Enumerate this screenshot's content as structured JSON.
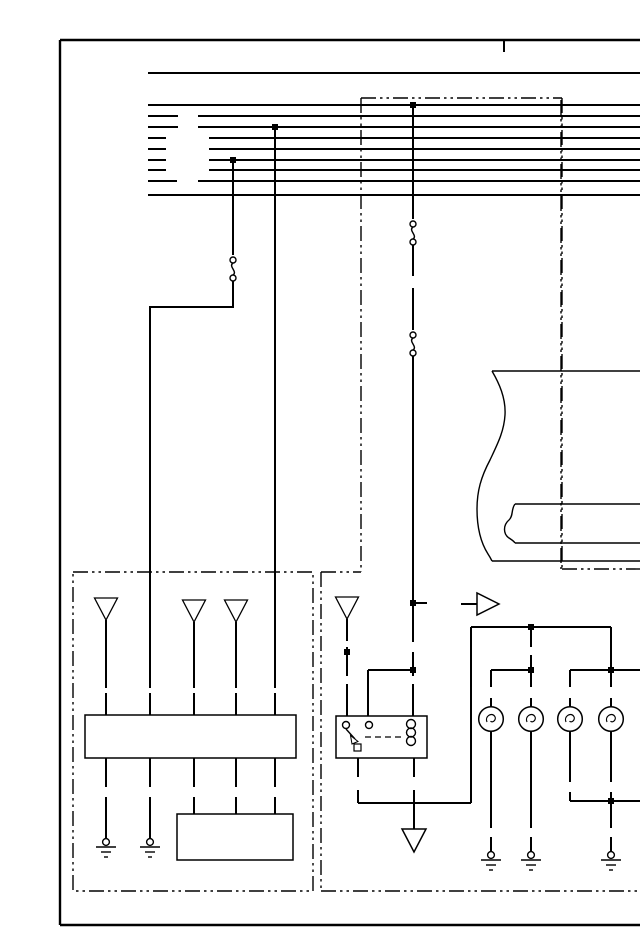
{
  "meta": {
    "title": "automotive wiring diagram page (no visible text labels)",
    "background_color": "#ffffff",
    "line_color": "#000000"
  },
  "symbols": {
    "junction_dot": "solid square dot = wire junction",
    "triangle_down_open": "shielded/system terminal arrow icon",
    "large_triangle_down_open": "chassis ground terminal icon",
    "circle_with_bars": "ground point icon (circle over 3 shrinking bars)",
    "squiggle_between_circles": "inline connector icon",
    "wire_gap": "connector break between harness segments",
    "right_arrow_open": "circuit continuation arrow icon",
    "dash_dot_outline": "harness / assembly boundary",
    "torn_edge_box": "partial component continued off-page",
    "circle_with_filament": "lamp bulb icon",
    "coil_and_switch_box": "relay (coil + normally-open switch)"
  },
  "components": {
    "bus_lines_count": 9,
    "top_feed_lines_count": 1,
    "lamp_count": 4,
    "ground_point_count": 5,
    "chassis_ground_count": 1,
    "relay_count": 1,
    "module_boxes_count": 3,
    "inline_connector_count": 3,
    "terminal_triangle_count": 4,
    "continuation_arrow_count": 1
  }
}
